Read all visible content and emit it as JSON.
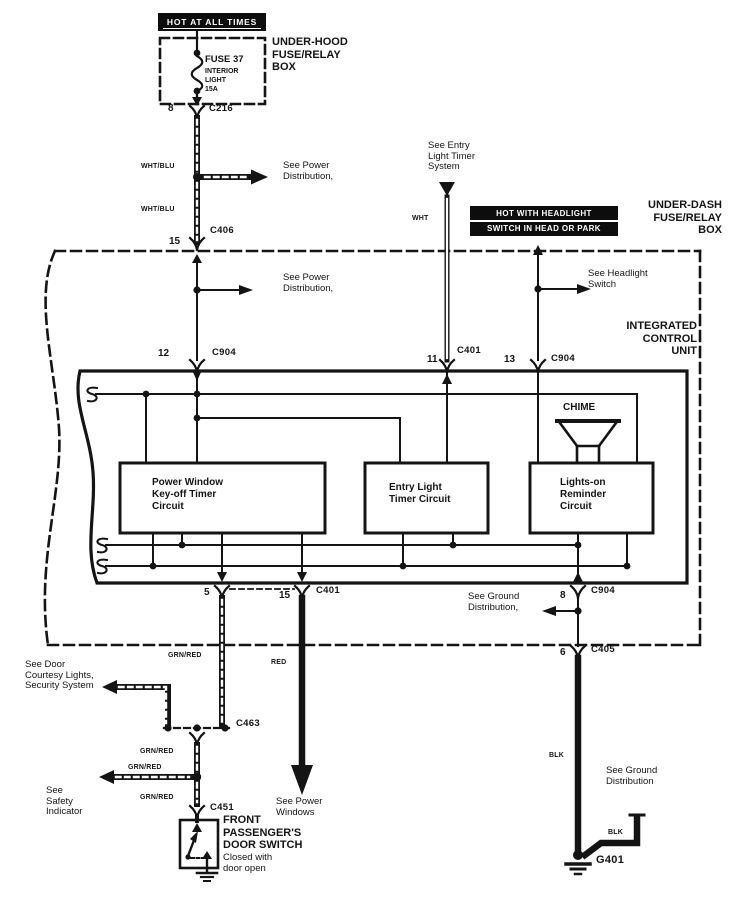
{
  "banners": {
    "hot_at_all_times": "HOT AT ALL TIMES",
    "hot_with_headlight_line1": "HOT WITH HEADLIGHT",
    "hot_with_headlight_line2": "SWITCH IN HEAD OR PARK"
  },
  "underhood": {
    "label": "UNDER-HOOD\nFUSE/RELAY\nBOX",
    "fuse_name": "FUSE 37",
    "fuse_detail": "INTERIOR\nLIGHT\n15A"
  },
  "underdash": {
    "label": "UNDER-DASH\nFUSE/RELAY\nBOX"
  },
  "icu": {
    "label": "INTEGRATED\nCONTROL\nUNIT",
    "chime": "CHIME",
    "power_window": "Power Window\nKey-off Timer\nCircuit",
    "entry_light": "Entry Light\nTimer Circuit",
    "lights_on": "Lights-on\nReminder\nCircuit"
  },
  "door_switch": {
    "title": "FRONT\nPASSENGER'S\nDOOR SWITCH",
    "note": "Closed with\ndoor open"
  },
  "refs": {
    "power_dist_1": "See Power\nDistribution,",
    "power_dist_2": "See Power\nDistribution,",
    "entry_light_timer": "See Entry\nLight Timer\nSystem",
    "headlight_switch": "See Headlight\nSwitch",
    "ground_dist_1": "See Ground\nDistribution,",
    "ground_dist_2": "See Ground\nDistribution",
    "door_courtesy": "See Door\nCourtesy Lights,\nSecurity System",
    "safety_indicator": "See\nSafety\nIndicator",
    "power_windows": "See Power\nWindows"
  },
  "pins": {
    "fuse_out": "8",
    "c406": "15",
    "icu12": "12",
    "icu11": "11",
    "icu13": "13",
    "icu5": "5",
    "icu15": "15",
    "icu8": "8",
    "c405": "6"
  },
  "connectors": {
    "c216": "C216",
    "c406": "C406",
    "c904_top": "C904",
    "c401_top": "C401",
    "c904_right": "C904",
    "c401_bottom": "C401",
    "c904_bottom": "C904",
    "c405": "C405",
    "c463": "C463",
    "c451": "C451",
    "g401": "G401"
  },
  "wire_labels": {
    "whtblu_a": "WHT/BLU",
    "whtblu_b": "WHT/BLU",
    "wht": "WHT",
    "grnred_a": "GRN/RED",
    "grnred_b": "GRN/RED",
    "grnred_c": "GRN/RED",
    "grnred_d": "GRN/RED",
    "red": "RED",
    "blk_a": "BLK",
    "blk_b": "BLK"
  },
  "colors": {
    "ink": "#141414",
    "paper": "#ffffff"
  }
}
